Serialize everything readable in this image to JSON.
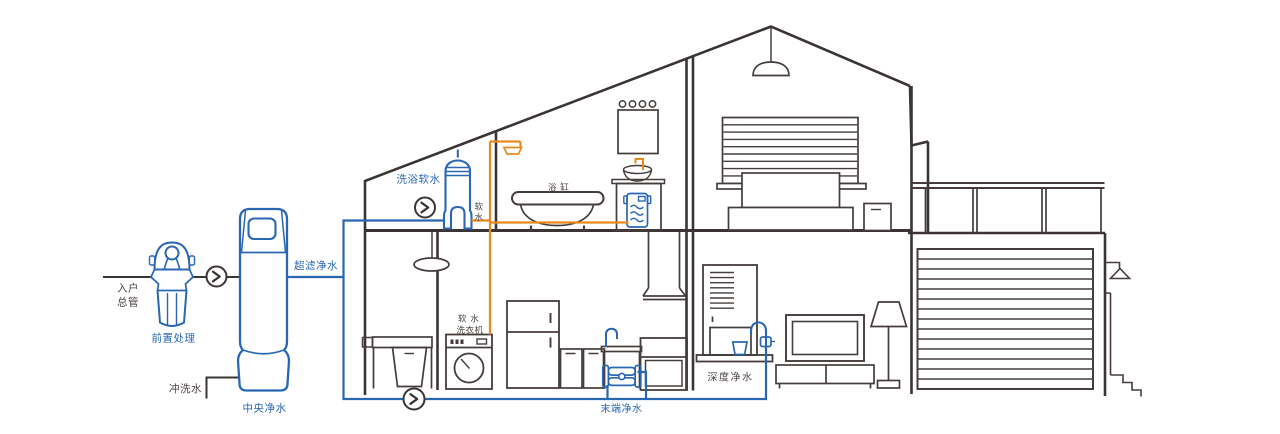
{
  "labels": {
    "inlet_l1": "入户",
    "inlet_l2": "总管",
    "prefilter": "前置处理",
    "flush": "冲洗水",
    "central": "中央净水",
    "ultra": "超滤净水",
    "bath_soft": "洗浴软水",
    "soft_c1": "软",
    "soft_c2": "水",
    "bathtub": "浴 缸",
    "washer_l1": "软 水",
    "washer_l2": "洗衣机",
    "terminal": "末端净水",
    "deep": "深度净水"
  },
  "colors": {
    "pipe_blue": "#2a67b2",
    "pipe_orange": "#e8891c",
    "outline_dark": "#3b3434",
    "label_gray": "#4c4442"
  }
}
